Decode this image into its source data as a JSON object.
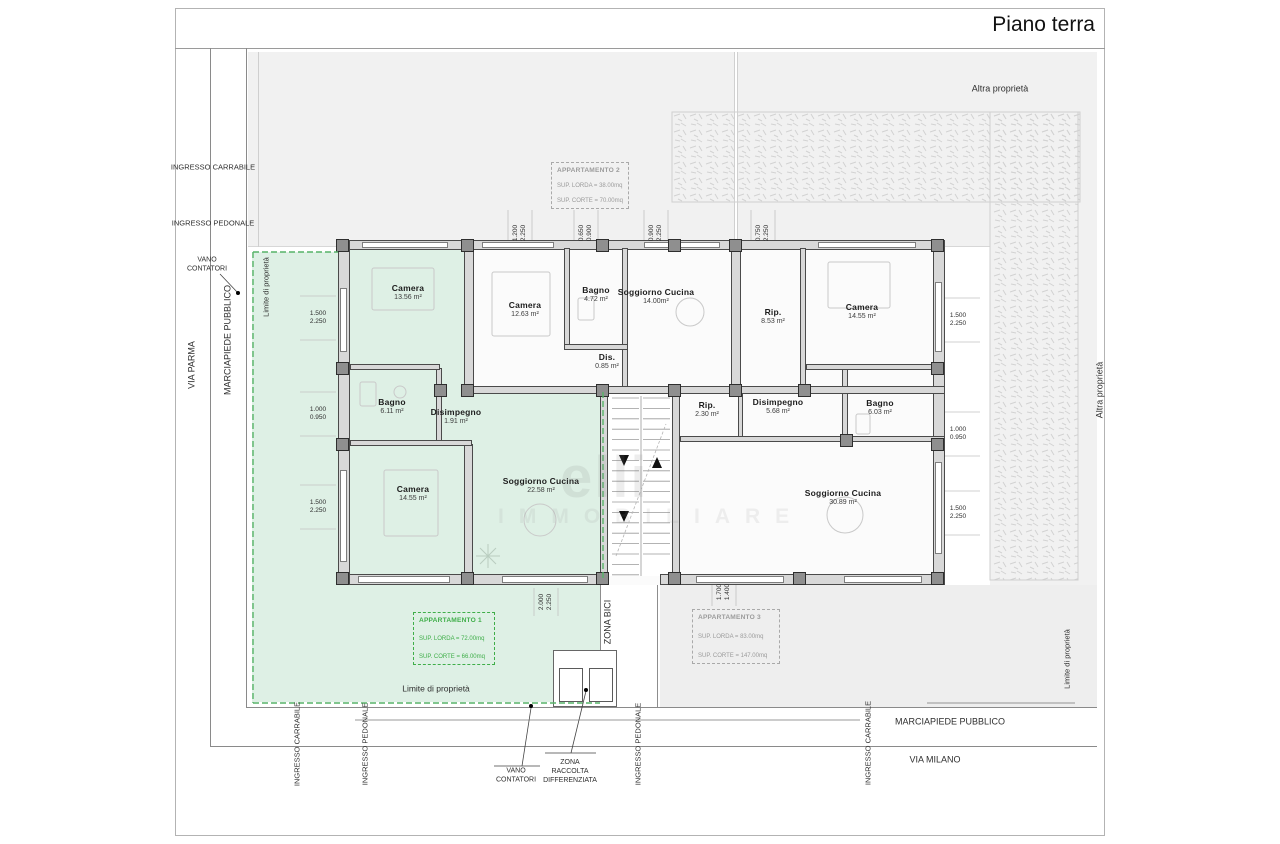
{
  "title": "Piano terra",
  "watermark": {
    "line1": "elli",
    "line2": "IMMOBILIARE"
  },
  "site_labels": {
    "altra-proprieta-top": "Altra proprietà",
    "altra-proprieta-right": "Altra proprietà",
    "via-parma": "VIA PARMA",
    "marciapiede-left": "MARCIAPIEDE PUBBLICO",
    "ingresso-carrabile-left": "INGRESSO CARRABILE",
    "ingresso-pedonale-left": "INGRESSO PEDONALE",
    "vano-contatori-left": "VANO\nCONTATORI",
    "limite-left": "Limite di proprietà",
    "limite-bottom": "Limite di proprietà",
    "limite-right": "Limite di proprietà",
    "zona-bici": "ZONA BICI",
    "ingresso-carrabile-b1": "INGRESSO CARRABILE",
    "ingresso-pedonale-b1": "INGRESSO PEDONALE",
    "ingresso-pedonale-b2": "INGRESSO PEDONALE",
    "ingresso-carrabile-b2": "INGRESSO CARRABILE",
    "vano-contatori-bottom": "VANO\nCONTATORI",
    "zona-raccolta": "ZONA\nRACCOLTA\nDIFFERENZIATA",
    "marciapiede-bottom": "MARCIAPIEDE PUBBLICO",
    "via-milano": "VIA MILANO"
  },
  "apartments": [
    {
      "name": "APPARTAMENTO 1",
      "lorda": "SUP. LORDA = 72.00mq",
      "corte": "SUP. CORTE = 66.00mq"
    },
    {
      "name": "APPARTAMENTO 2",
      "lorda": "SUP. LORDA = 38.00mq",
      "corte": "SUP. CORTE = 70.00mq"
    },
    {
      "name": "APPARTAMENTO 3",
      "lorda": "SUP. LORDA = 83.00mq",
      "corte": "SUP. CORTE = 147.00mq"
    }
  ],
  "rooms": [
    {
      "id": "camera-1",
      "name": "Camera",
      "area": "13.56 m²"
    },
    {
      "id": "camera-2",
      "name": "Camera",
      "area": "12.63 m²"
    },
    {
      "id": "bagno-2",
      "name": "Bagno",
      "area": "4.72 m²"
    },
    {
      "id": "soggiorno-2",
      "name": "Soggiorno Cucina",
      "area": "14.00m²"
    },
    {
      "id": "dis-2",
      "name": "Dis.",
      "area": "0.85 m²"
    },
    {
      "id": "rip-3a",
      "name": "Rip.",
      "area": "8.53 m²"
    },
    {
      "id": "camera-3",
      "name": "Camera",
      "area": "14.55 m²"
    },
    {
      "id": "bagno-1",
      "name": "Bagno",
      "area": "6.11 m²"
    },
    {
      "id": "disimpegno-1",
      "name": "Disimpegno",
      "area": "1.91 m²"
    },
    {
      "id": "rip-3b",
      "name": "Rip.",
      "area": "2.30 m²"
    },
    {
      "id": "disimpegno-3",
      "name": "Disimpegno",
      "area": "5.68 m²"
    },
    {
      "id": "bagno-3",
      "name": "Bagno",
      "area": "6.03 m²"
    },
    {
      "id": "camera-1b",
      "name": "Camera",
      "area": "14.55 m²"
    },
    {
      "id": "soggiorno-1",
      "name": "Soggiorno Cucina",
      "area": "22.58 m²"
    },
    {
      "id": "soggiorno-3",
      "name": "Soggiorno Cucina",
      "area": "30.89 m²"
    }
  ],
  "dimensions": [
    {
      "a": "1.200",
      "b": "2.250"
    },
    {
      "a": "0.650",
      "b": "0.900"
    },
    {
      "a": "0.900",
      "b": "2.250"
    },
    {
      "a": "0.750",
      "b": "2.250"
    },
    {
      "a": "1.500",
      "b": "2.250"
    },
    {
      "a": "1.000",
      "b": "0.950"
    },
    {
      "a": "1.500",
      "b": "2.250"
    },
    {
      "a": "1.500",
      "b": "2.250"
    },
    {
      "a": "1.000",
      "b": "0.950"
    },
    {
      "a": "1.500",
      "b": "2.250"
    },
    {
      "a": "2.000",
      "b": "2.250"
    },
    {
      "a": "1.700",
      "b": "1.400"
    }
  ],
  "colors": {
    "apartment1_fill": "#def0e5",
    "courtyard_gray": "#f1f1f1",
    "annotation_green": "#3fae49"
  }
}
